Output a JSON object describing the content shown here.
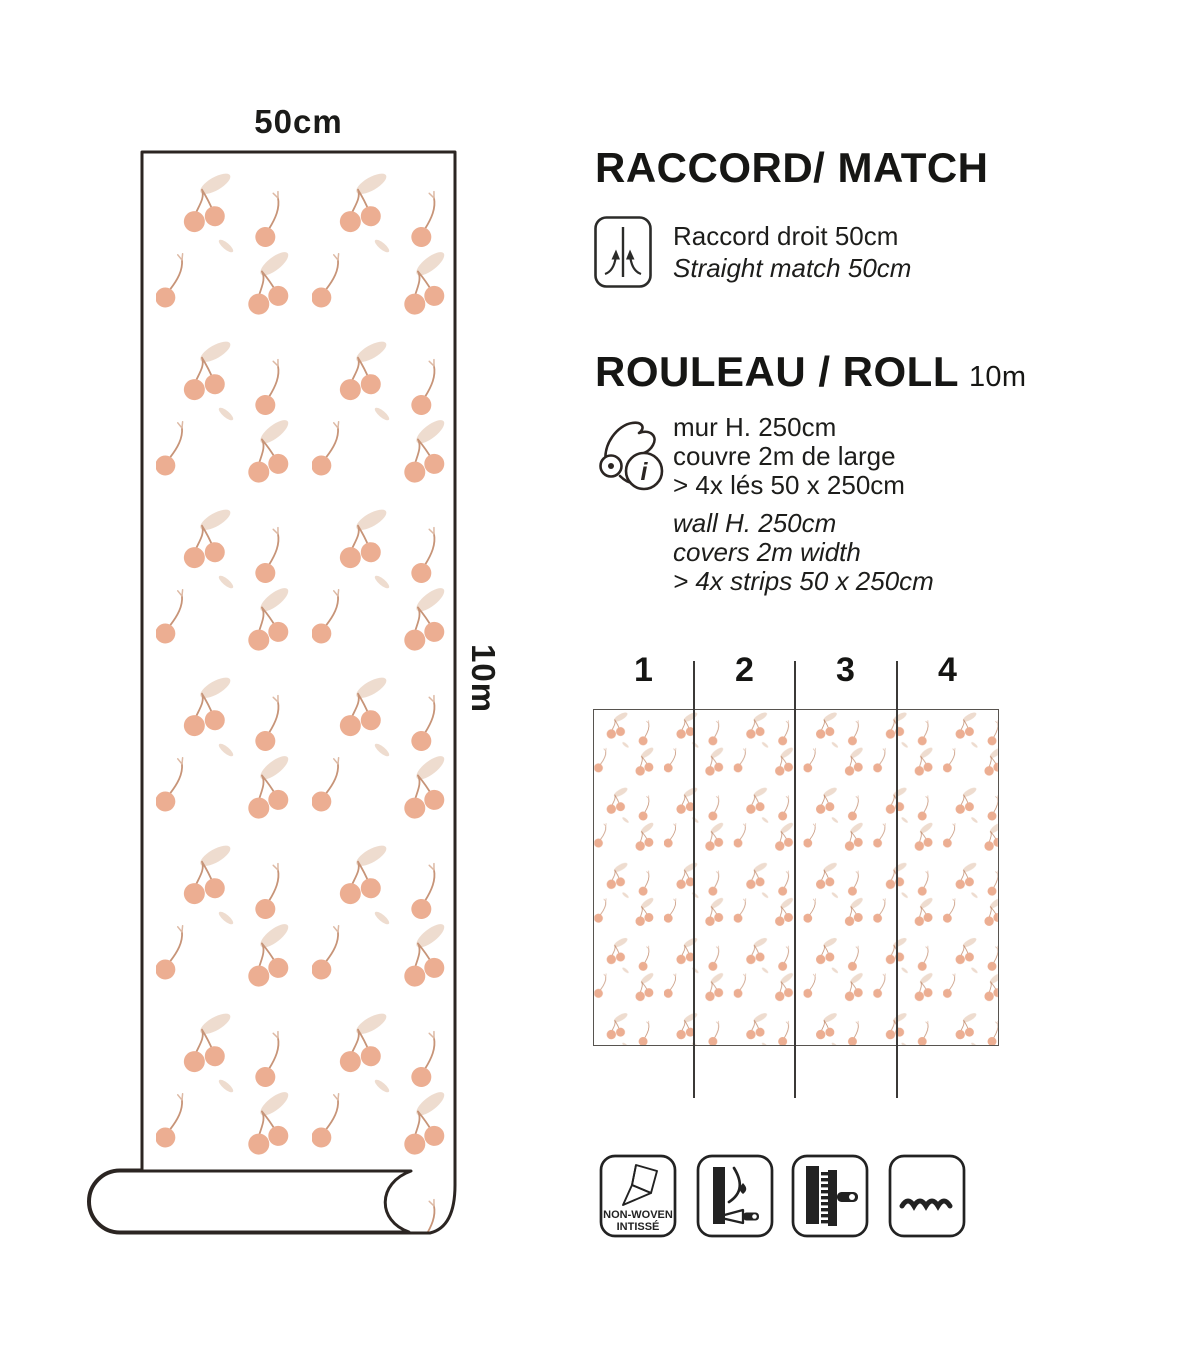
{
  "left_panel": {
    "width_label": "50cm",
    "length_label": "10m"
  },
  "match_section": {
    "title": "RACCORD/ MATCH",
    "line_fr": "Raccord droit 50cm",
    "line_en": "Straight match 50cm"
  },
  "roll_section": {
    "title": "ROULEAU / ROLL",
    "roll_length": "10m",
    "info_glyph": "i",
    "fr_lines": [
      "mur H. 250cm",
      "couvre 2m de large",
      "> 4x lés 50 x 250cm"
    ],
    "en_lines": [
      "wall H. 250cm",
      "covers 2m width",
      "> 4x strips 50 x 250cm"
    ]
  },
  "strips_diagram": {
    "numbers": [
      "1",
      "2",
      "3",
      "4"
    ]
  },
  "badges": {
    "nonwoven_line1": "NON-WOVEN",
    "nonwoven_line2": "INTISSÉ"
  },
  "colors": {
    "cherry": "#ecae92",
    "leaf": "#eedccf",
    "stem": "#c79478",
    "outline": "#2b2522",
    "text": "#1b1b19"
  }
}
